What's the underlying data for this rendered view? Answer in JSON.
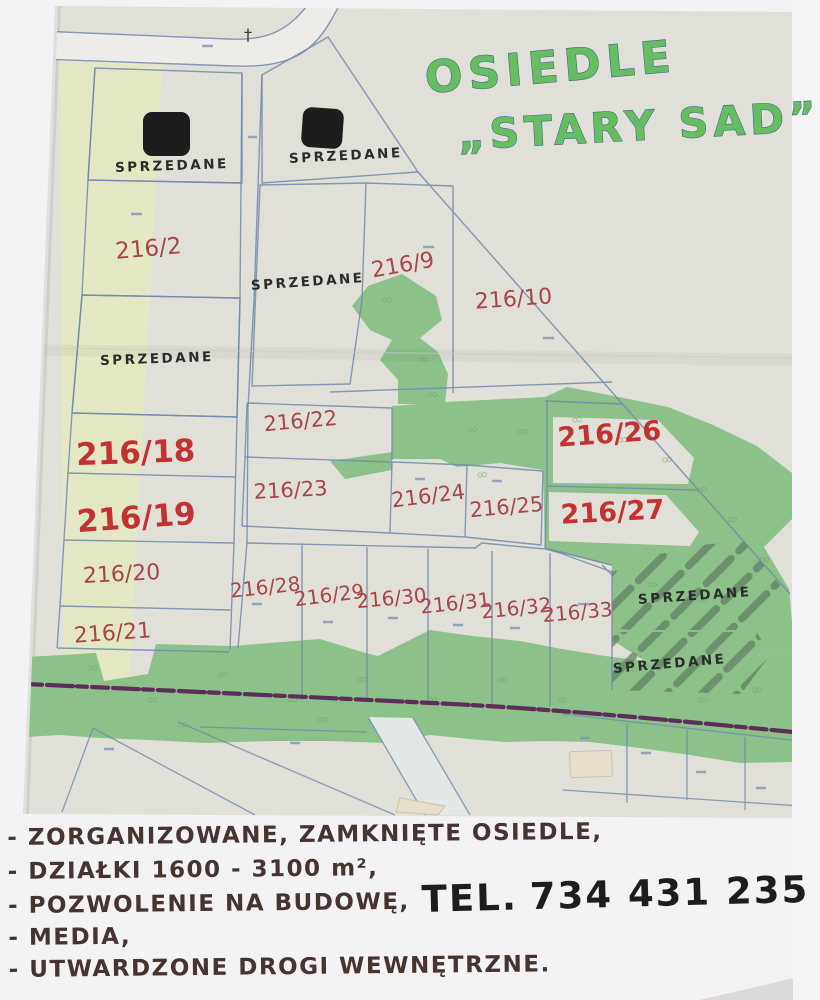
{
  "title": {
    "line1": "OSIEDLE",
    "line2": "„STARY SAD”"
  },
  "map": {
    "sold_label": "SPRZEDANE",
    "sold_plots_count": 6,
    "landmark_cross": "†",
    "plots": [
      {
        "label": "216/2",
        "status": "available"
      },
      {
        "label": "216/9",
        "status": "available"
      },
      {
        "label": "216/10",
        "status": "available"
      },
      {
        "label": "216/18",
        "status": "highlighted"
      },
      {
        "label": "216/19",
        "status": "highlighted"
      },
      {
        "label": "216/20",
        "status": "available"
      },
      {
        "label": "216/21",
        "status": "available"
      },
      {
        "label": "216/22",
        "status": "available"
      },
      {
        "label": "216/23",
        "status": "available"
      },
      {
        "label": "216/24",
        "status": "available"
      },
      {
        "label": "216/25",
        "status": "available"
      },
      {
        "label": "216/26",
        "status": "highlighted"
      },
      {
        "label": "216/27",
        "status": "highlighted"
      },
      {
        "label": "216/28",
        "status": "available"
      },
      {
        "label": "216/29",
        "status": "available"
      },
      {
        "label": "216/30",
        "status": "available"
      },
      {
        "label": "216/31",
        "status": "available"
      },
      {
        "label": "216/32",
        "status": "available"
      },
      {
        "label": "216/33",
        "status": "available"
      }
    ]
  },
  "notes": {
    "bullets": [
      "- ZORGANIZOWANE, ZAMKNIĘTE OSIEDLE,",
      "- DZIAŁKI 1600 - 3100 m²,",
      "- POZWOLENIE NA BUDOWĘ,",
      "- MEDIA,",
      "- UTWARDZONE DROGI WEWNĘTRZNE."
    ],
    "phone_label": "TEL.",
    "phone_number": "734 431 235"
  },
  "colors": {
    "title_green": "#66bd62",
    "plot_red": "#a7454b",
    "plot_red_bold": "#c13231",
    "greenery": "#8cc18a",
    "boundary_blue": "#7189ae",
    "purple_road": "#5a2156",
    "paper": "#f3f2f4",
    "map_background": "#e1e0d8",
    "yellow_strip": "#e4e7c2",
    "hatch_gray": "#8d8d89",
    "ink_brown": "#463430"
  }
}
